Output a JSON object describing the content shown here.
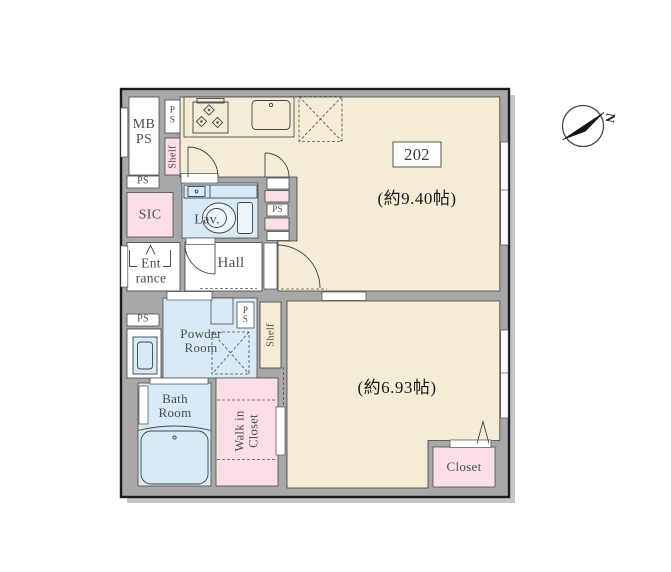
{
  "unit": {
    "number": "202",
    "main_area": "(約9.40帖)",
    "second_area": "(約6.93帖)"
  },
  "labels": {
    "mb_ps_1": "MB",
    "mb_ps_2": "PS",
    "ps": "PS",
    "ps_p": "P",
    "ps_s": "S",
    "shelf": "Shelf",
    "sic": "SIC",
    "entrance_1": "Ent",
    "entrance_2": "rance",
    "lav": "Lav.",
    "hall": "Hall",
    "powder_1": "Powder",
    "powder_2": "Room",
    "bath_1": "Bath",
    "bath_2": "Room",
    "wic_1": "Walk in",
    "wic_2": "Closet",
    "closet": "Closet",
    "north": "N"
  },
  "colors": {
    "wall": "#a8a8a8",
    "floor": "#f5ecd6",
    "wet_area": "#d8eaf6",
    "closet_pink": "#fbdee6",
    "shadow": "#c6c6c6",
    "outline": "#1b1b1b"
  }
}
